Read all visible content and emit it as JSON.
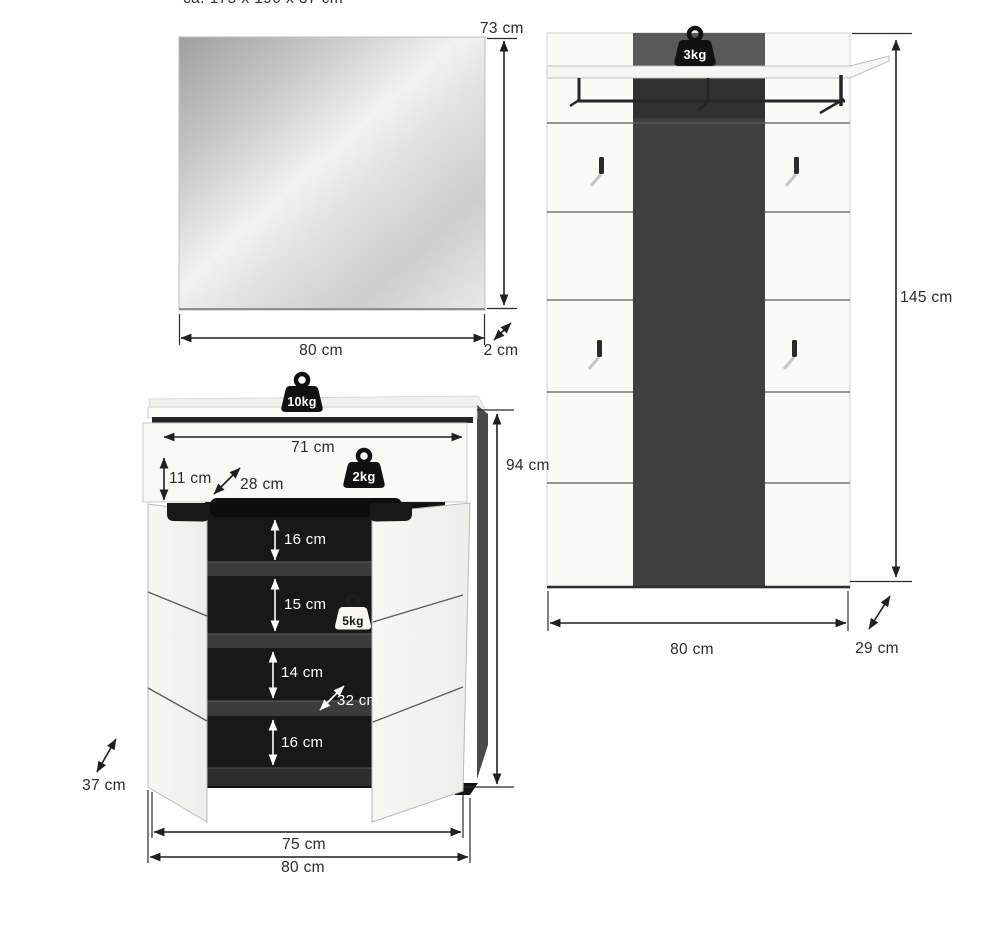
{
  "note_top": "ca. 175 x 190 x 37 cm",
  "colors": {
    "dark_stripe": "#3f3f3f",
    "interior": "#181818",
    "line": "#1f1f1f"
  },
  "mirror": {
    "height": "73 cm",
    "width": "80 cm",
    "depth": "2 cm"
  },
  "panel": {
    "capacity": "3kg",
    "height": "145 cm",
    "width": "80 cm",
    "depth": "29 cm"
  },
  "cabinet": {
    "top_capacity": "10kg",
    "drawer_capacity": "2kg",
    "shelf_capacity": "5kg",
    "inner_width": "71 cm",
    "drawer_height": "11 cm",
    "drawer_depth": "28 cm",
    "compartment_1": "16 cm",
    "compartment_2": "15 cm",
    "compartment_3": "14 cm",
    "compartment_4": "16 cm",
    "shelf_depth": "32 cm",
    "height": "94 cm",
    "depth": "37 cm",
    "inner_width_bottom": "75 cm",
    "width": "80 cm"
  }
}
